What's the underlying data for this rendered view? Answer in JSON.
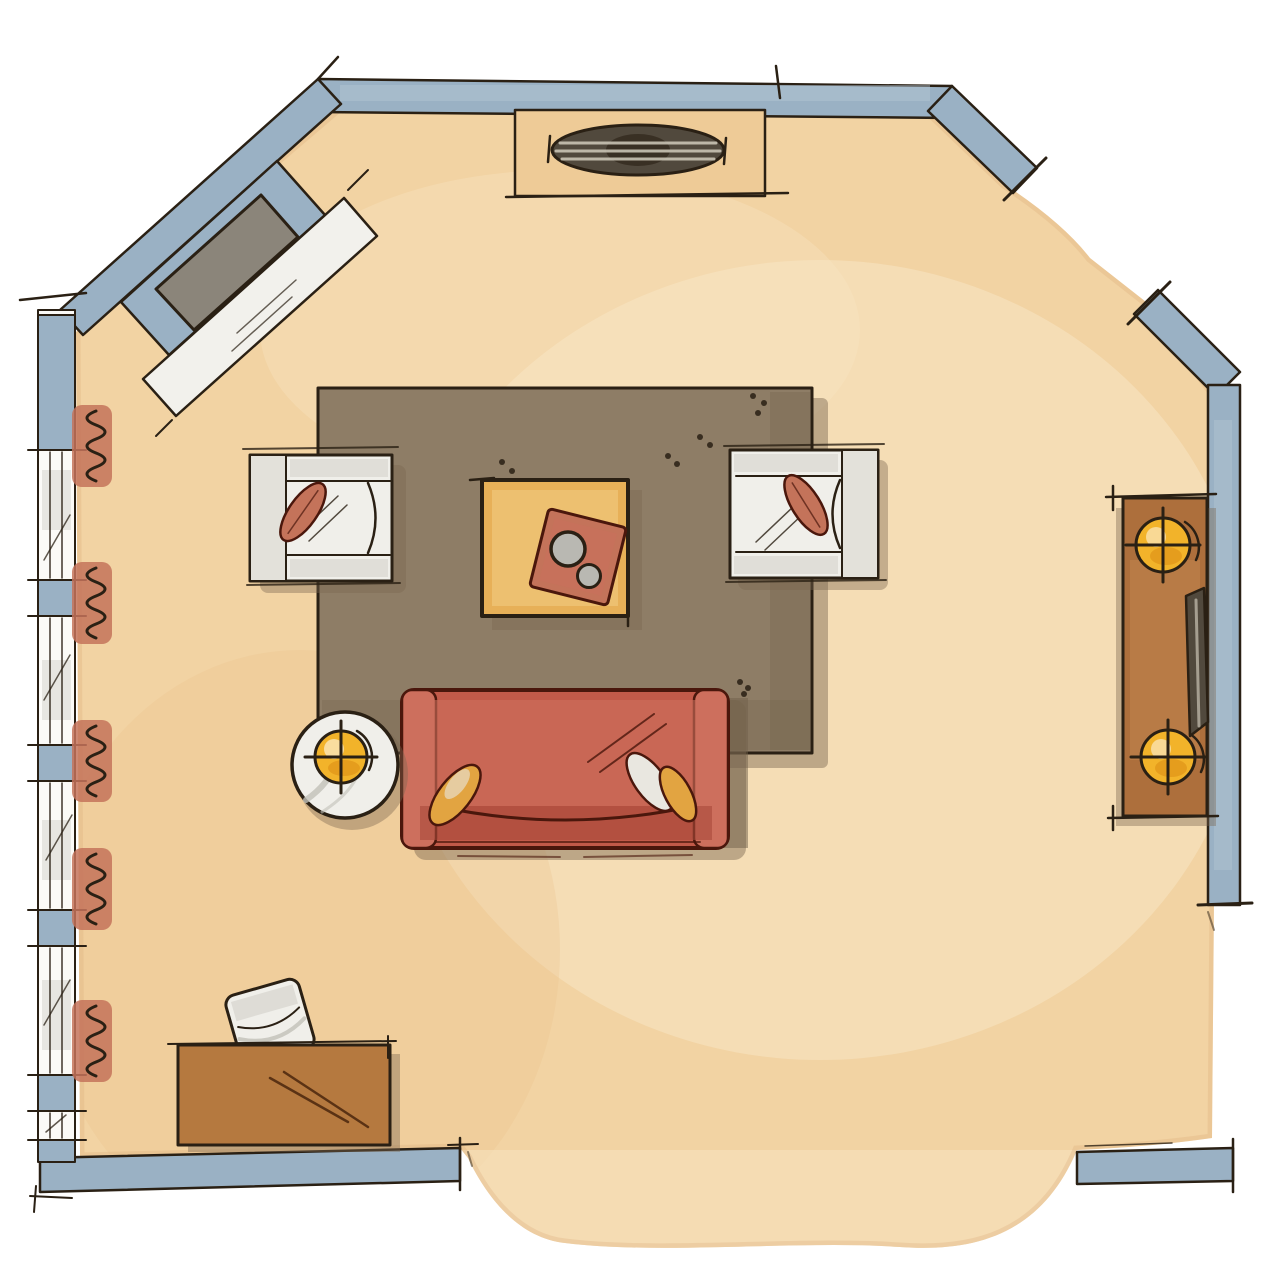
{
  "artwork": {
    "kind": "watercolor-floor-plan",
    "room": "living-room"
  },
  "palette": {
    "background": "#ffffff",
    "ink": "#2a2014",
    "wall_blue": "#9ab1c4",
    "wall_light": "#b6c8d5",
    "window_white": "#fbfaf7",
    "floor": "#f2d3a3",
    "floor_light": "#f8e6c4",
    "floor_mottle": "#eac28f",
    "floor_shadow": "#d9ad7a",
    "rug": "#8e7d66",
    "rug_dark": "#6f6049",
    "shadow": "#7a6650",
    "sofa": "#c25a49",
    "sofa_light": "#cd6f5d",
    "sofa_dark": "#a84a3a",
    "sofa_outline": "#4a170c",
    "terracotta": "#c4735a",
    "gold": "#e2a441",
    "white_pillow": "#e9e7e0",
    "white_f": "#f0efea",
    "white_dim": "#e3e1da",
    "gray_wash": "#c2c0b8",
    "ochre": "#e7b058",
    "ochre_light": "#f2cd85",
    "wood": "#ad6f3c",
    "wood_light": "#c58a52",
    "wood2": "#b5793f",
    "grain": "#5a3214",
    "lamp": "#f2b32a",
    "lamp_deep": "#e0951a",
    "bowl": "#b9b8b2",
    "firebox": "#8b857a",
    "hearth": "#f2f1ec",
    "media": "#51493d",
    "media_stripe": "#c9c3b4",
    "cabinet_tan": "#eecb97"
  },
  "scene_elements": [
    "corner-fireplace",
    "media-cabinet",
    "window-wall",
    "radiator",
    "area-rug",
    "armchair",
    "coffee-table",
    "serving-tray",
    "bowl",
    "sofa",
    "throw-pillow",
    "side-table",
    "table-lamp",
    "console-table",
    "desk",
    "desk-chair",
    "door-opening"
  ],
  "counts": {
    "armchairs": 2,
    "sofas": 1,
    "table_lamps": 3,
    "radiators": 5,
    "window_sections": 5,
    "door_openings": 3,
    "throw_pillows_on_sofa": 3
  }
}
